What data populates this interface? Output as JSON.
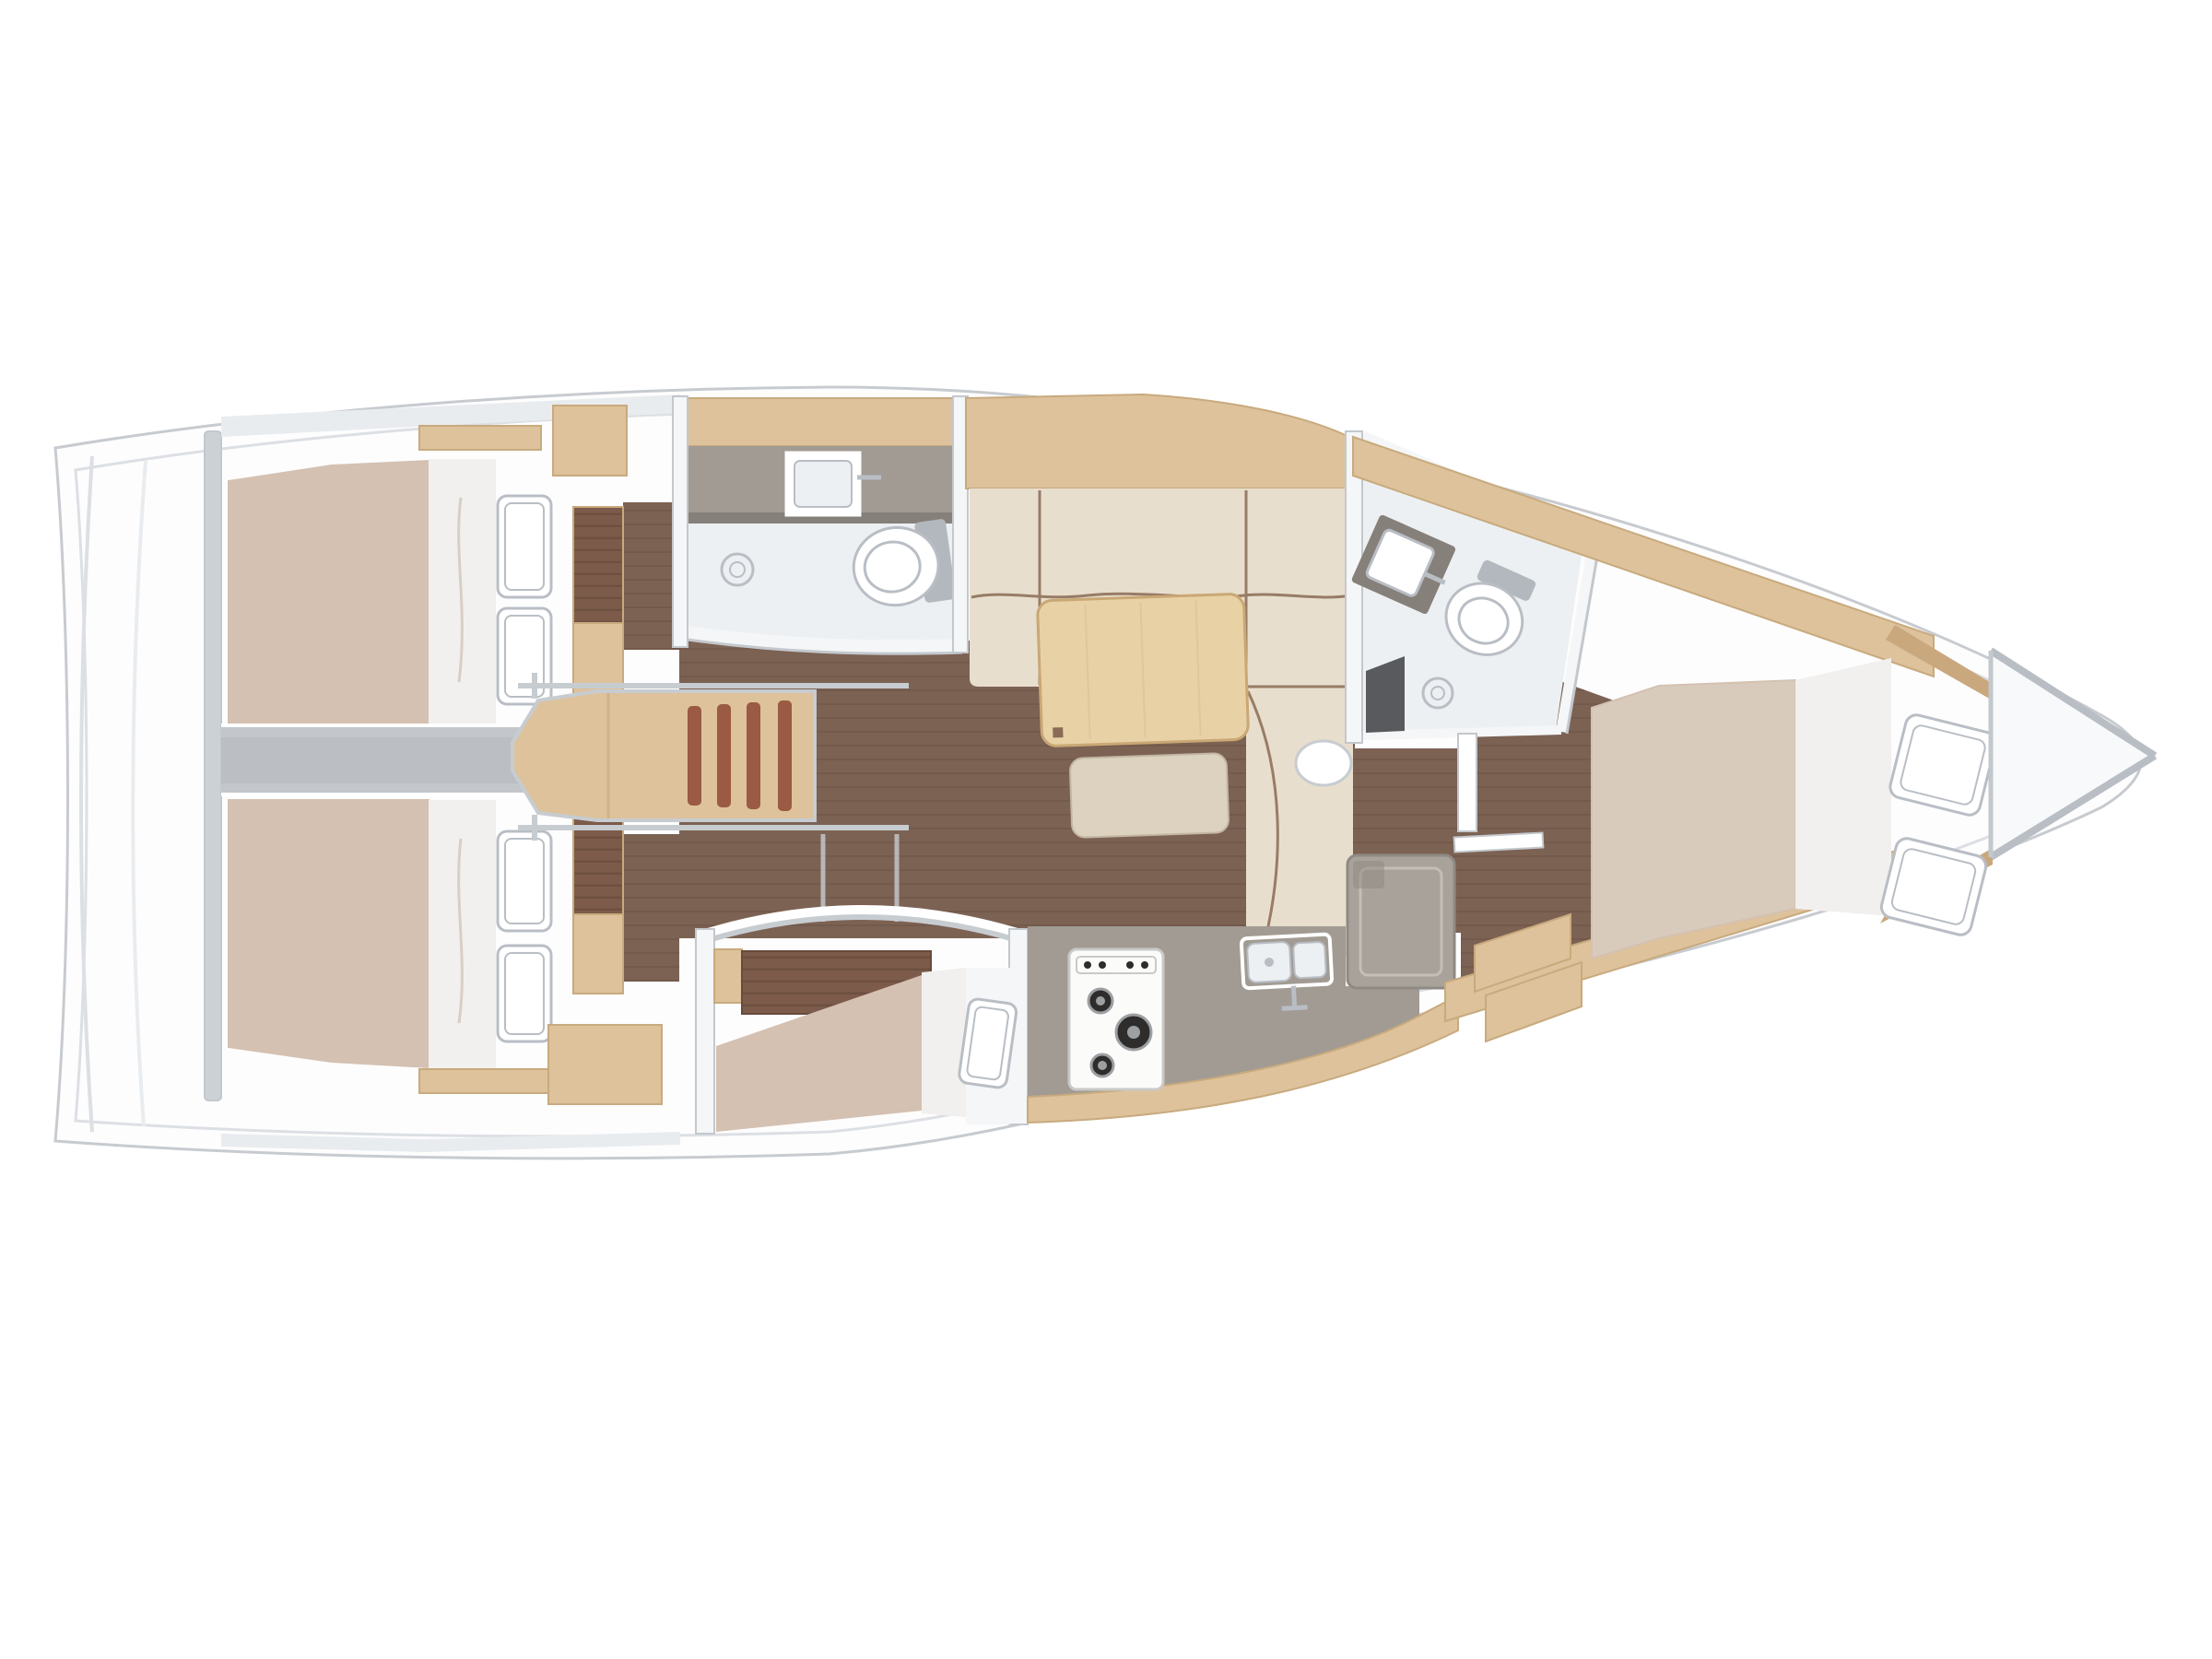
{
  "meta": {
    "title": "Sailing yacht interior layout — top-down floor plan",
    "view": "overhead",
    "orientation": "bow-right-stern-left"
  },
  "palette": {
    "bg": "#ffffff",
    "hull": "#fdfdfe",
    "hull_stroke": "#c7cbd0",
    "hull_inner": "#dcdfe3",
    "deck_shade": "#e9ecef",
    "wall": "#f4f6f7",
    "wall_stroke": "#c3c8cd",
    "bulkhead": "#ccd1d6",
    "engine_band": "#c3c7cb",
    "engine_core": "#bbbfc4",
    "rail": "#c7ccd1",
    "floor": "#7c6253",
    "floor_line": "#6b5347",
    "wood": "#ddc29b",
    "wood_stroke": "#c8aa7e",
    "wood_dark": "#caa87e",
    "tambour": "#7d5b4a",
    "tambour_line": "#684b3d",
    "step_slat": "#9a5a44",
    "mattress": "#d4c1b2",
    "mattress_fwd": "#d8cbbc",
    "bedding": "#f1f0ee",
    "bedding_line": "#d8cfc4",
    "pillow": "#ffffff",
    "pillow_stroke": "#b9bec5",
    "counter": "#a19b93",
    "counter_dark": "#86807a",
    "bath_floor": "#edf0f2",
    "fixture_stroke": "#b9bec5",
    "fixture_fill": "#f7f9fa",
    "tank_gray": "#b3b8be",
    "appliance": "#a8a29b",
    "appliance_stroke": "#8f8a84",
    "appliance_inner": "#c4beb7",
    "burner": "#2e2d2b",
    "burner_ring": "#9da0a3",
    "sofa": "#e8decd",
    "sofa_seam": "#8a6b55",
    "table": "#e9d1a6",
    "table_stroke": "#c9a875",
    "table_grain": "#dcbf92",
    "bench": "#ddd2c0",
    "bench_stroke": "#c3b7a3",
    "seat_dark": "#585a5e",
    "stove": "#fbfbfa",
    "stove_stroke": "#c9c9c7",
    "white": "#ffffff"
  },
  "areas": {
    "stern_platform": {
      "name": "Stern / swim platform"
    },
    "aft_cabin_port": {
      "name": "Aft double cabin (port, top)",
      "berth": "double",
      "pillows": 2,
      "fixtures": [
        "tambour-wardrobe",
        "lockers",
        "shelf"
      ]
    },
    "aft_cabin_starboard": {
      "name": "Aft double cabin (starboard, bottom)",
      "berth": "double",
      "pillows": 2,
      "fixtures": [
        "tambour-wardrobe",
        "lockers",
        "shelf"
      ]
    },
    "engine_compartment": {
      "name": "Engine compartment between aft cabins"
    },
    "companionway": {
      "name": "Companionway entry stairs",
      "steps": 4,
      "handrails": 2
    },
    "head_aft": {
      "name": "Aft head (bathroom, top)",
      "fixtures": [
        "vanity-counter",
        "washbasin",
        "faucet",
        "shower-drain",
        "toilet"
      ]
    },
    "saloon": {
      "name": "Saloon",
      "fixtures": [
        "L-shaped-sofa",
        "dining-table",
        "bench",
        "pouf"
      ]
    },
    "mid_cabin": {
      "name": "Mid single-berth cabin (bottom)",
      "berth": "single",
      "pillows": 1,
      "fixtures": [
        "tambour-locker",
        "arched-doorway"
      ]
    },
    "galley": {
      "name": "Galley",
      "fixtures": [
        "stove-3-burners",
        "double-sink",
        "faucet",
        "refrigerator",
        "counter",
        "cabinet-front"
      ]
    },
    "head_forward": {
      "name": "Forward head (bathroom)",
      "fixtures": [
        "vanity-washbasin",
        "toilet",
        "shower-drain",
        "shower-seat",
        "door"
      ]
    },
    "forward_cabin": {
      "name": "Forward owner cabin",
      "berth": "double",
      "pillows": 2,
      "fixtures": [
        "entry-steps",
        "side-platforms",
        "door"
      ]
    },
    "bow_locker": {
      "name": "Bow anchor locker"
    }
  }
}
